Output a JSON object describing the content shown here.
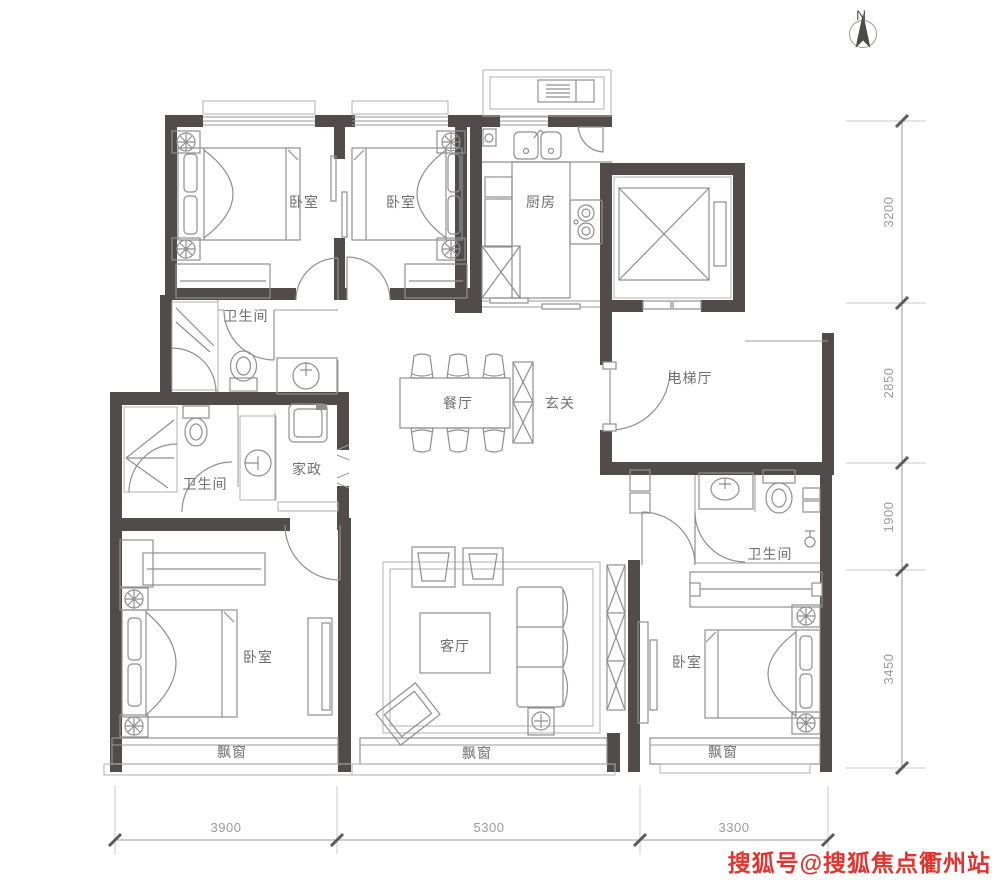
{
  "compass": {
    "label": "N"
  },
  "rooms": [
    {
      "id": "bedroom-top-left",
      "label": "卧室"
    },
    {
      "id": "bedroom-top-middle",
      "label": "卧室"
    },
    {
      "id": "kitchen",
      "label": "厨房"
    },
    {
      "id": "bath-top",
      "label": "卫生间"
    },
    {
      "id": "elevator-hall",
      "label": "电梯厅"
    },
    {
      "id": "dining",
      "label": "餐厅"
    },
    {
      "id": "foyer",
      "label": "玄关"
    },
    {
      "id": "housekeeping",
      "label": "家政"
    },
    {
      "id": "bath-left",
      "label": "卫生间"
    },
    {
      "id": "bath-right",
      "label": "卫生间"
    },
    {
      "id": "living",
      "label": "客厅"
    },
    {
      "id": "bedroom-bottom-left",
      "label": "卧室"
    },
    {
      "id": "bedroom-bottom-right",
      "label": "卧室"
    },
    {
      "id": "bay-window-left",
      "label": "飘窗"
    },
    {
      "id": "bay-window-middle",
      "label": "飘窗"
    },
    {
      "id": "bay-window-right",
      "label": "飘窗"
    }
  ],
  "dimensions": {
    "right": [
      "3200",
      "2850",
      "1900",
      "3450"
    ],
    "bottom": [
      "3900",
      "5300",
      "3300"
    ]
  },
  "watermark": {
    "text": "搜狐号@搜狐焦点衢州站",
    "color": "#e0342f"
  },
  "colors": {
    "wall": "#514c4b",
    "furniture": "#8f8f8f",
    "label": "#6f6f6f",
    "dimension": "#9a9a9a"
  }
}
